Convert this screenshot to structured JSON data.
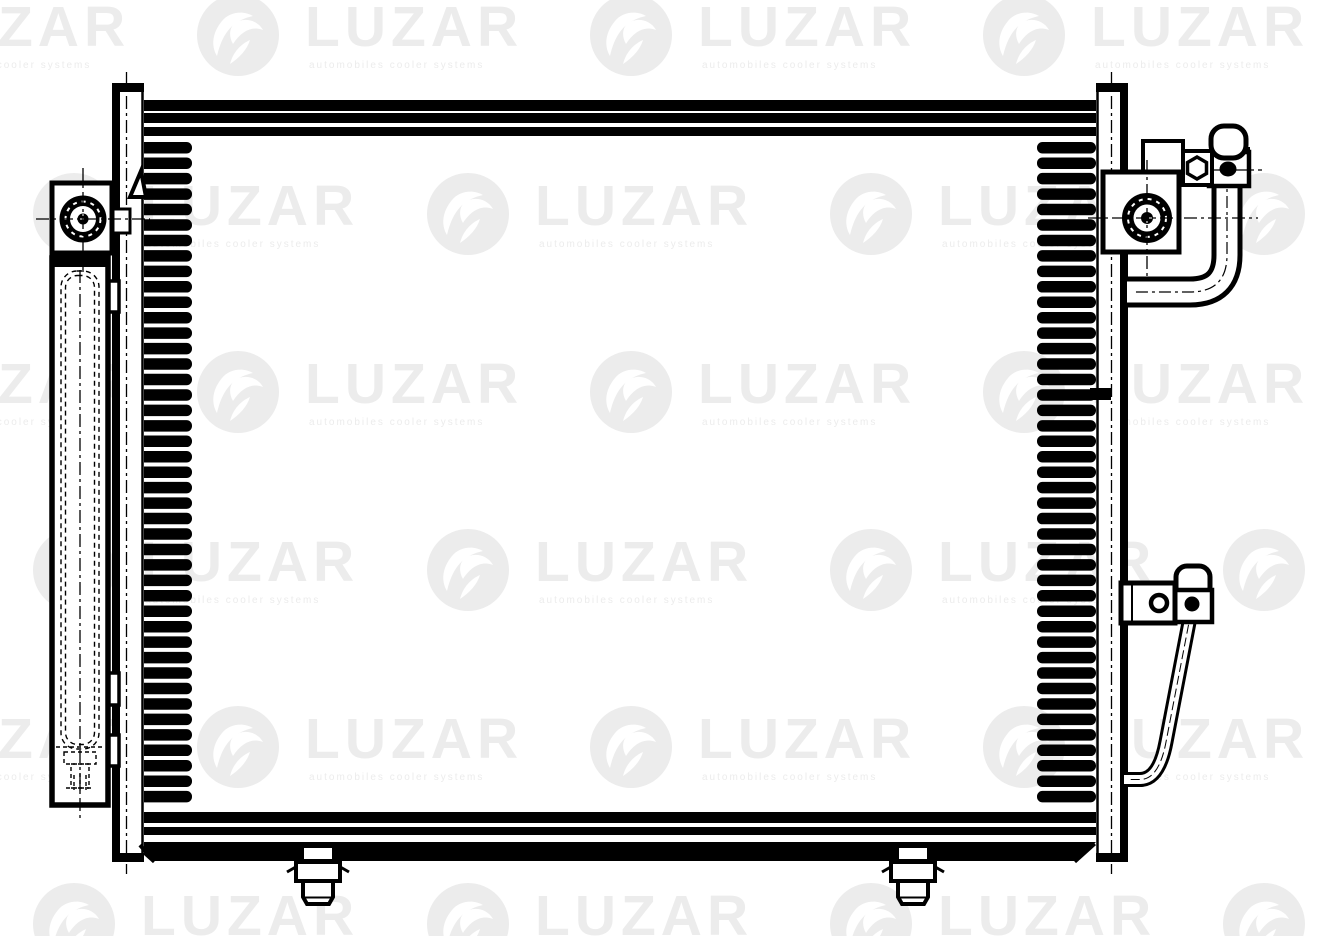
{
  "page": {
    "background_color": "#ffffff",
    "line_color": "#000000",
    "part_fill_color": "#ffffff"
  },
  "watermark": {
    "text": "LUZAR",
    "tagline": "automobiles cooler systems",
    "color": "#ececec",
    "rows": [
      {
        "cy": 35,
        "logos": [
          -196,
          197,
          590,
          983
        ]
      },
      {
        "cy": 214,
        "logos": [
          33,
          427,
          830,
          1223
        ]
      },
      {
        "cy": 392,
        "logos": [
          -196,
          197,
          590,
          983
        ]
      },
      {
        "cy": 570,
        "logos": [
          33,
          427,
          830,
          1223
        ]
      },
      {
        "cy": 747,
        "logos": [
          -196,
          197,
          590,
          983
        ]
      },
      {
        "cy": 924,
        "logos": [
          33,
          427,
          830,
          1223
        ]
      }
    ]
  },
  "drawing": {
    "fins": {
      "count": 43,
      "y_start": 142,
      "pitch": 15.45,
      "bar_height": 11.5,
      "left_x": 133,
      "right_x": 1037,
      "bar_width": 59
    }
  }
}
